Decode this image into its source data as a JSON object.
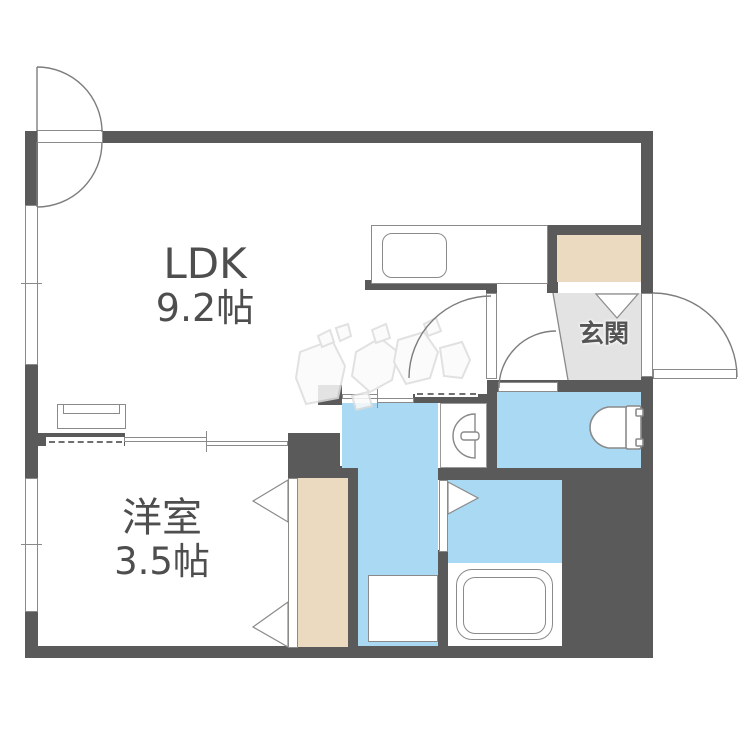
{
  "plan_type": "floorplan",
  "labels": {
    "ldk": {
      "line1": "LDK",
      "line2": "9.2帖"
    },
    "bedroom": {
      "line1": "洋室",
      "line2": "3.5帖"
    },
    "entrance": "玄関"
  },
  "rooms": [
    {
      "name": "LDK",
      "size": "9.2帖",
      "floor_color": "#ffffff"
    },
    {
      "name": "洋室",
      "size": "3.5帖",
      "floor_color": "#ffffff"
    },
    {
      "name": "玄関",
      "size": "",
      "floor_color": "#e3e3e3"
    },
    {
      "name": "toilet-room",
      "size": "",
      "floor_color": "#a9d9f3"
    },
    {
      "name": "washroom",
      "size": "",
      "floor_color": "#a9d9f3"
    },
    {
      "name": "bathroom",
      "size": "",
      "floor_color": "#a9d9f3"
    }
  ],
  "fixtures": [
    "kitchen-counter",
    "kitchen-sink",
    "shoe-cabinet",
    "toilet",
    "washbasin",
    "bathtub",
    "washing-machine-pan",
    "closet",
    "entrance-door",
    "interior-doors",
    "sliding-doors",
    "windows"
  ],
  "colors": {
    "wall": "#5a5a5b",
    "water_area": "#a9d9f3",
    "storage": "#ebd9c0",
    "entrance_floor": "#e3e3e3",
    "line": "#8a8a8a",
    "text": "#4e4e4e"
  },
  "watermark": {
    "description": "light-gray blocky katakana logo watermark",
    "text": "ジモティ"
  }
}
